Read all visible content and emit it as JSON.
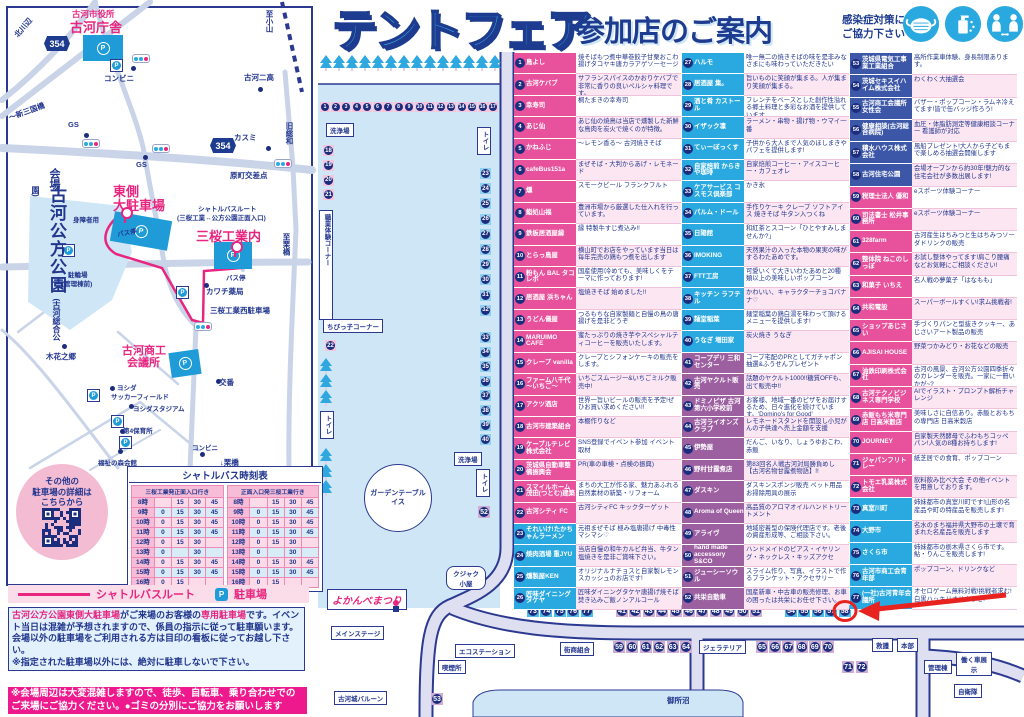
{
  "palette": {
    "pink": "#e8519c",
    "blue": "#2aa9e0",
    "purple": "#9c5fa0",
    "navy": "#3c57a8",
    "accent_pink": "#e8257f",
    "navy_text": "#22368e",
    "park_blue": "#cfe6f6",
    "road_lavender": "#dfdff2",
    "highlight_red": "#e8231f"
  },
  "title": {
    "main": "テントフェア",
    "sub": "参加店のご案内"
  },
  "infection_notice": {
    "text": "感染症対策に\nご協力下さい",
    "icons": [
      "mask-icon",
      "hand-sanitizer-icon",
      "social-distance-icon"
    ]
  },
  "access_map": {
    "park_name_main": "古河公方公園",
    "park_name_sub": "(古河総合公園)",
    "route_shields": [
      "354",
      "354"
    ],
    "qr_caption": "その他の\n駐車場の詳細は\nこちらから",
    "labels": [
      {
        "t": "北川辺",
        "x": 12,
        "y": 22,
        "c": "s",
        "r": -50
      },
      {
        "t": "古河市役所",
        "x": 72,
        "y": 8,
        "c": "pkS"
      },
      {
        "t": "古河庁舎",
        "x": 70,
        "y": 17,
        "c": "pkL"
      },
      {
        "t": "コンビニ",
        "x": 104,
        "y": 73,
        "c": "s"
      },
      {
        "t": "古河二高",
        "x": 244,
        "y": 72,
        "c": "s"
      },
      {
        "t": "至小山",
        "x": 264,
        "y": 10,
        "c": "s",
        "v": 1
      },
      {
        "t": "旧総和",
        "x": 284,
        "y": 122,
        "c": "s",
        "v": 1
      },
      {
        "t": "～新三国橋",
        "x": 8,
        "y": 106,
        "c": "s",
        "r": -20
      },
      {
        "t": "GS",
        "x": 68,
        "y": 120,
        "c": "s"
      },
      {
        "t": "GS",
        "x": 136,
        "y": 160,
        "c": "s"
      },
      {
        "t": "カスミ",
        "x": 234,
        "y": 132,
        "c": "s"
      },
      {
        "t": "原町交差点",
        "x": 230,
        "y": 170,
        "c": "s"
      },
      {
        "t": "会場",
        "x": 46,
        "y": 168,
        "c": "vM",
        "v": 1
      },
      {
        "t": "東側",
        "x": 113,
        "y": 181,
        "c": "pkL"
      },
      {
        "t": "大駐車場",
        "x": 113,
        "y": 195,
        "c": "pkL"
      },
      {
        "t": "身障者用",
        "x": 73,
        "y": 214,
        "c": "xs"
      },
      {
        "t": "バス停",
        "x": 117,
        "y": 227,
        "c": "xs",
        "r": -10
      },
      {
        "t": "シャトルバスルート",
        "x": 198,
        "y": 203,
        "c": "xs"
      },
      {
        "t": "(三桜工業↔公方公園正面入口)",
        "x": 177,
        "y": 212,
        "c": "xs"
      },
      {
        "t": "三桜工業内",
        "x": 196,
        "y": 226,
        "c": "pkL"
      },
      {
        "t": "至栗橋",
        "x": 281,
        "y": 233,
        "c": "s",
        "v": 1
      },
      {
        "t": "バス停",
        "x": 226,
        "y": 272,
        "c": "xs"
      },
      {
        "t": "駐輪場",
        "x": 68,
        "y": 269,
        "c": "xs"
      },
      {
        "t": "(管理棟前)",
        "x": 62,
        "y": 278,
        "c": "xs"
      },
      {
        "t": "カワチ薬局",
        "x": 206,
        "y": 286,
        "c": "s"
      },
      {
        "t": "三桜工業西駐車場",
        "x": 210,
        "y": 305,
        "c": "s"
      },
      {
        "t": "木花之郷",
        "x": 46,
        "y": 351,
        "c": "s"
      },
      {
        "t": "古河商工",
        "x": 122,
        "y": 342,
        "c": "pkM"
      },
      {
        "t": "会議所",
        "x": 127,
        "y": 354,
        "c": "pkM"
      },
      {
        "t": "交番",
        "x": 219,
        "y": 377,
        "c": "s"
      },
      {
        "t": "ヨシダ",
        "x": 117,
        "y": 382,
        "c": "xs"
      },
      {
        "t": "サッカーフィールド",
        "x": 111,
        "y": 391,
        "c": "xs"
      },
      {
        "t": "ヨシダスタジアム",
        "x": 133,
        "y": 403,
        "c": "xs"
      },
      {
        "t": "第4保育所",
        "x": 123,
        "y": 425,
        "c": "xs"
      },
      {
        "t": "コンビニ",
        "x": 192,
        "y": 442,
        "c": "xs"
      },
      {
        "t": "福祉の森会館",
        "x": 98,
        "y": 457,
        "c": "xs"
      },
      {
        "t": "↓栗橋",
        "x": 220,
        "y": 457,
        "c": "s"
      }
    ]
  },
  "timetable": {
    "title": "シャトルバス時刻表",
    "left_header": "三桜工業発正面入口行き",
    "right_header": "正面入口発三桜工業行き",
    "rows": [
      {
        "h": "8時",
        "m": [
          "",
          "15",
          "30",
          "45"
        ]
      },
      {
        "h": "9時",
        "m": [
          "0",
          "15",
          "30",
          "45"
        ]
      },
      {
        "h": "10時",
        "m": [
          "0",
          "15",
          "30",
          "45"
        ]
      },
      {
        "h": "11時",
        "m": [
          "0",
          "15",
          "30",
          "45"
        ]
      },
      {
        "h": "12時",
        "m": [
          "0",
          "15",
          "30",
          ""
        ]
      },
      {
        "h": "13時",
        "m": [
          "0",
          "",
          "30",
          ""
        ]
      },
      {
        "h": "14時",
        "m": [
          "0",
          "15",
          "30",
          "45"
        ]
      },
      {
        "h": "15時",
        "m": [
          "0",
          "15",
          "30",
          "45"
        ]
      },
      {
        "h": "16時",
        "m": [
          "0",
          "15",
          "",
          ""
        ]
      }
    ]
  },
  "legend": {
    "route": "シャトルバスルート",
    "parking": "駐車場",
    "parking_mark": "P"
  },
  "notes": {
    "parking_segments": [
      {
        "t": "古河公方公園東側大駐車場",
        "hl": true
      },
      {
        "t": "がご来場のお客様の",
        "hl": false
      },
      {
        "t": "専用駐車場",
        "hl": true
      },
      {
        "t": "です。イベント当日は混雑が予想されますので、係員の指示に従って駐車願います。会場以外の駐車場をご利用される方は目印の看板に従ってお越し下さい。",
        "hl": false
      },
      {
        "t": "\n※指定された駐車場以外には、絶対に駐車しないで下さい。",
        "hl": false
      }
    ],
    "crowd_note": "※会場周辺は大変混雑しますので、徒歩、自転車、乗り合わせでの\nご来場にご協力ください。●ゴミの分別にご協力をお願いします"
  },
  "venue_map": {
    "highlight_stall": 58,
    "labels": [
      {
        "t": "洗浄場",
        "x": 326,
        "y": 123,
        "c": "box"
      },
      {
        "t": "トイレ",
        "x": 477,
        "y": 127,
        "c": "boxv"
      },
      {
        "t": "職業体験コーナー",
        "x": 319,
        "y": 210,
        "c": "boxv",
        "h": 102
      },
      {
        "t": "ちびっ子コーナー",
        "x": 323,
        "y": 319,
        "c": "box"
      },
      {
        "t": "トイレ",
        "x": 320,
        "y": 411,
        "c": "boxv"
      },
      {
        "t": "洗浄場",
        "x": 454,
        "y": 452,
        "c": "box"
      },
      {
        "t": "トイレ",
        "x": 476,
        "y": 469,
        "c": "boxv"
      },
      {
        "t": "クジャク小屋",
        "x": 446,
        "y": 566,
        "c": "oct"
      },
      {
        "t": "よかんべまつり",
        "x": 327,
        "y": 589,
        "c": "sign"
      },
      {
        "t": "メインステージ",
        "x": 331,
        "y": 626,
        "c": "box"
      },
      {
        "t": "古河城バルーン",
        "x": 334,
        "y": 691,
        "c": "box"
      },
      {
        "t": "エコステーション",
        "x": 455,
        "y": 644,
        "c": "box"
      },
      {
        "t": "喫煙所",
        "x": 438,
        "y": 660,
        "c": "box"
      },
      {
        "t": "街商組合",
        "x": 560,
        "y": 642,
        "c": "box"
      },
      {
        "t": "ジェラテリア",
        "x": 699,
        "y": 640,
        "c": "box"
      },
      {
        "t": "救護",
        "x": 872,
        "y": 638,
        "c": "box"
      },
      {
        "t": "本部",
        "x": 897,
        "y": 638,
        "c": "box"
      },
      {
        "t": "管理棟",
        "x": 924,
        "y": 660,
        "c": "box"
      },
      {
        "t": "働く車展示",
        "x": 956,
        "y": 652,
        "c": "b2"
      },
      {
        "t": "自衛隊",
        "x": 954,
        "y": 684,
        "c": "box"
      },
      {
        "t": "御所沼",
        "x": 664,
        "y": 694,
        "c": "wl"
      }
    ],
    "garden_label": "ガーデンテーブル\nイス",
    "stall_groups": [
      {
        "id": "top-row",
        "color": "pinkL",
        "nums": [
          1,
          2,
          3,
          4,
          5,
          6,
          7,
          8,
          9,
          10,
          11,
          12,
          13,
          14,
          15,
          16,
          17
        ]
      },
      {
        "id": "left-col",
        "color": "pinkL",
        "nums": [
          18,
          19,
          20,
          21
        ]
      },
      {
        "id": "stall-22",
        "color": "pinkL",
        "nums": [
          22
        ]
      },
      {
        "id": "right-col-a",
        "color": "blueL",
        "nums": [
          23,
          24,
          25,
          26,
          27,
          28,
          29,
          30,
          31,
          32
        ]
      },
      {
        "id": "right-col-b",
        "color": "blueL",
        "nums": [
          33,
          34,
          35,
          36,
          37,
          38,
          39,
          40
        ]
      },
      {
        "id": "stall-52",
        "color": "purpleL",
        "nums": [
          52
        ]
      },
      {
        "id": "stall-53",
        "color": "purpleL",
        "nums": [
          53
        ]
      },
      {
        "id": "row-73-77",
        "color": "blueS",
        "nums": [
          73,
          74,
          75,
          76,
          77
        ]
      },
      {
        "id": "row-41-51",
        "color": "purpleL",
        "nums": [
          41,
          42,
          43,
          44,
          45,
          46,
          47,
          48,
          49,
          50,
          51
        ]
      },
      {
        "id": "row-54-58",
        "color": "blueS",
        "nums": [
          54,
          55,
          56,
          57,
          58
        ]
      },
      {
        "id": "row-59-64",
        "color": "purpleL",
        "nums": [
          59,
          60,
          61,
          62,
          63,
          64
        ]
      },
      {
        "id": "row-65-70",
        "color": "purpleL",
        "nums": [
          65,
          66,
          67,
          68,
          69,
          70
        ]
      },
      {
        "id": "row-71-72",
        "color": "purpleL",
        "nums": [
          71,
          72
        ]
      }
    ]
  },
  "stores": [
    {
      "n": 1,
      "name": "鳥よし",
      "desc": "焼そばもつ煮中華巻餃子甘栗おこわ揚げタコヤキ唐カラアゲソーセージ",
      "color": "pink"
    },
    {
      "n": 2,
      "name": "古河ケバブ",
      "desc": "サフランスパイスのかおりケバブで非常に香りの良いペルシャ料理です。",
      "color": "pink"
    },
    {
      "n": 3,
      "name": "幸寿司",
      "desc": "桐たまきの幸寿司",
      "color": "pink"
    },
    {
      "n": 4,
      "name": "あじ仙",
      "desc": "あじ仙の焼鳥は当店で燻製した新鮮な鳥肉を炭火で焼くのが特徴。",
      "color": "pink"
    },
    {
      "n": 5,
      "name": "かねふじ",
      "desc": "～レモン香る～ 古河焼きそば",
      "color": "pink"
    },
    {
      "n": 6,
      "name": "cafeBus151a",
      "desc": "まぜそば・大判からあげ・レモネード",
      "color": "pink"
    },
    {
      "n": 7,
      "name": "燻",
      "desc": "スモークビール フランクフルト",
      "color": "pink"
    },
    {
      "n": 8,
      "name": "鮨処山福",
      "desc": "豊洲市場から厳選した仕入れを行っています。",
      "color": "pink"
    },
    {
      "n": 9,
      "name": "鉄板居酒屋縁",
      "desc": "縁 特製牛すじ煮込み!!",
      "color": "pink"
    },
    {
      "n": 10,
      "name": "とらっ鳥屋",
      "desc": "横山町でお店をやっています当日は毎年完売の鶏もつ煮を出します",
      "color": "pink"
    },
    {
      "n": 11,
      "name": "粉もん BAL タコレボ",
      "desc": "国産使用!冷めても、美味しくをテーマに作っております!",
      "color": "pink"
    },
    {
      "n": 12,
      "name": "居酒屋 浜ちゃん",
      "desc": "塩焼きそば 始めました!!",
      "color": "pink"
    },
    {
      "n": 13,
      "name": "うどん儀屋",
      "desc": "つるもちな自家製麺と自慢の鳥の唐揚げを是非どうぞ",
      "color": "pink"
    },
    {
      "n": 14,
      "name": "MARUIMO CAFE",
      "desc": "蜜たっぷりの焼き芋やスペシャルティコーヒーを販売いたします。",
      "color": "pink"
    },
    {
      "n": 15,
      "name": "クレープ vanilla",
      "desc": "クレープとシフォンケーキの販売をします。",
      "color": "pink"
    },
    {
      "n": 16,
      "name": "ファーム八千代～いちご～",
      "desc": "いちごスムージー&いちごミルク販売中!",
      "color": "pink"
    },
    {
      "n": 17,
      "name": "アクツ酒店",
      "desc": "世界一旨いビールの販売を予定!ぜひお買い求めください!!",
      "color": "pink"
    },
    {
      "n": 18,
      "name": "古河市建築組合",
      "desc": "本棚作りなど",
      "color": "pink"
    },
    {
      "n": 19,
      "name": "ケーブルテレビ株式会社",
      "desc": "SNS登録でイベント参加 イベント取材",
      "color": "pink"
    },
    {
      "n": 20,
      "name": "茨城県自動車整備振興会",
      "desc": "PR(車の車検・点検の振興)",
      "color": "pink"
    },
    {
      "n": 21,
      "name": "スマイルホーム茂田(つとむ)建築",
      "desc": "まちの大工が作る家、魅力あふれる自然素材の新築・リフォーム",
      "color": "pink"
    },
    {
      "n": 22,
      "name": "古河シティ FC",
      "desc": "古河シティFC キックターゲット",
      "color": "pink"
    },
    {
      "n": 23,
      "name": "それいけ!たかちゃんラーメン",
      "desc": "元祖まぜそば 極み塩唐揚げ 中毒性マシマシ♡",
      "color": "blue"
    },
    {
      "n": 24,
      "name": "焼肉酒場 重JYU",
      "desc": "当店自慢の和牛カルビ弁当、牛タン塩焼きを是非ご賞味下さい。",
      "color": "blue"
    },
    {
      "n": 25,
      "name": "燻製屋KEN",
      "desc": "オリジナルナチョスと自家製レモンスカッシュのお店です!",
      "color": "blue"
    },
    {
      "n": 26,
      "name": "匠味ダイニングタケヤ",
      "desc": "匠味ダイニングタケヤ唐揚げ焼そば焚き込みご飯ノンアルコール",
      "color": "blue"
    },
    {
      "n": 27,
      "name": "ハルモ",
      "desc": "唯一無二の焼きそばの味を是非みなさまにも味わっていただきたい",
      "color": "blue"
    },
    {
      "n": 28,
      "name": "居酒屋 集。",
      "desc": "旨いものに笑顔が集まる。人が集まり笑顔が集まる。",
      "color": "blue"
    },
    {
      "n": 29,
      "name": "酒と肴 カストール",
      "desc": "フレンチをベースとした創作性溢れる郷土料理と多彩なお酒を提供しています",
      "color": "blue"
    },
    {
      "n": 30,
      "name": "イザック凛",
      "desc": "ラーメン・串物・揚げ物・ウマイ一番",
      "color": "blue"
    },
    {
      "n": 31,
      "name": "てぃーぼっくす",
      "desc": "子供から大人まで人気のほしまきやパフェを提供します!",
      "color": "blue"
    },
    {
      "n": 32,
      "name": "自家焙煎 からきや珈琲",
      "desc": "自家焙煎コーヒー・アイスコーヒー・カフェオレ",
      "color": "blue"
    },
    {
      "n": 33,
      "name": "ケアサービス コスモス倶楽部",
      "desc": "かき氷",
      "color": "blue"
    },
    {
      "n": 34,
      "name": "パルム・ドール",
      "desc": "手作りケーキ クレープ ソフトアイス 焼きそば 牛タン入つくね",
      "color": "blue"
    },
    {
      "n": 35,
      "name": "日陽館",
      "desc": "和紅茶とスコーン「ひとやすみしませんか?」",
      "color": "blue"
    },
    {
      "n": 36,
      "name": "IMOKING",
      "desc": "天然果汁の入った本物の果実の味がするわたあめです。",
      "color": "blue"
    },
    {
      "n": 37,
      "name": "FTT工房",
      "desc": "可愛いくて大きいわたあめと20種類以上の美味しいポップコーン",
      "color": "blue"
    },
    {
      "n": 38,
      "name": "キッチン ラフテル",
      "desc": "かわいい、キャラクターチョコバナナ♡",
      "color": "blue"
    },
    {
      "n": 39,
      "name": "麺堂稲葉",
      "desc": "麺堂稲葉の鶏白湯を味わって頂けるメニューを提供します!",
      "color": "blue"
    },
    {
      "n": 40,
      "name": "うなぎ 増田家",
      "desc": "炭火焼き うなぎ",
      "color": "blue"
    },
    {
      "n": 41,
      "name": "コープデリ 三和センター",
      "desc": "コープ宅配のPRとしてガチャポン抽選&ふうせんプレゼント",
      "color": "purple"
    },
    {
      "n": 42,
      "name": "古河ヤクルト販売",
      "desc": "話題のヤクルト1000!!糖質OFFも、出て販売中!!",
      "color": "purple"
    },
    {
      "n": 43,
      "name": "ドミノピザ 古河第六小学校前",
      "desc": "お客様、地域一番のピザをお届けするため、日々進化を続けています。'Domino's for Good'",
      "color": "purple"
    },
    {
      "n": 44,
      "name": "古河ライオンズクラブ",
      "desc": "レモネードスタンドを開設し小児がんの子供達へ売上金額を支援",
      "color": "purple"
    },
    {
      "n": 45,
      "name": "伊勢屋",
      "desc": "だんご、いなり、しょうゆおこわ、赤飯",
      "color": "purple"
    },
    {
      "n": 46,
      "name": "野村甘露煮店",
      "desc": "第83回名人戦古河対局勝負めし【古河名物甘露煮物語】!!",
      "color": "purple"
    },
    {
      "n": 47,
      "name": "ダスキン",
      "desc": "ダスキンスポンジ販売 ペット用品お掃除用具の展示",
      "color": "purple"
    },
    {
      "n": 48,
      "name": "Aroma of Queen",
      "desc": "高品質のアロマオイルハンドトリートメント",
      "color": "purple"
    },
    {
      "n": 49,
      "name": "アライヴ",
      "desc": "地域密着型の保険代理店です。老後の資産形成等、ご相談下さい。",
      "color": "purple"
    },
    {
      "n": 50,
      "name": "hand made accessory S&CO",
      "desc": "ハンドメイドのピアス・イヤリング・ネックレス・キッズアクセ",
      "color": "purple"
    },
    {
      "n": 51,
      "name": "ジューシーソウル",
      "desc": "スライム作り、写真、イラストで作るブランケット・アクセサリー",
      "color": "purple"
    },
    {
      "n": 52,
      "name": "共栄自動車",
      "desc": "国産新車・中古車の販売修理、お車の困ったは共栄にお任せ下さい。",
      "color": "purple"
    },
    {
      "n": 53,
      "name": "茨城県電気工事業工業組合",
      "desc": "高所作業車体験、身長制限あります。",
      "color": "navy"
    },
    {
      "n": 54,
      "name": "茨城セキスイハイム株式会社",
      "desc": "わくわく大抽選会",
      "color": "navy"
    },
    {
      "n": 55,
      "name": "古河商工会議所女性会",
      "desc": "バザー・ポップコーン・ラムネ冷えてます!皆で缶バッジ作ろう!",
      "color": "navy"
    },
    {
      "n": 56,
      "name": "健康相談(古河総合病院)",
      "desc": "血圧・体脂肪測定等健康相談コーナー 看護師が対応",
      "color": "navy"
    },
    {
      "n": 57,
      "name": "積水ハウス株式会社",
      "desc": "風船プレゼント!大人から子どもまで楽しめる抽選会開催します",
      "color": "navy"
    },
    {
      "n": 58,
      "name": "古河住宅公園",
      "desc": "会場オープンから約30年!魅力的な住宅会社が多数出展します!",
      "color": "navy"
    },
    {
      "n": 59,
      "name": "税理士法人 優和",
      "desc": "eスポーツ体験コーナー",
      "color": "pink"
    },
    {
      "n": 60,
      "name": "司法書士 松井事務所",
      "desc": "eスポーツ体験コーナー",
      "color": "pink"
    },
    {
      "n": 61,
      "name": "328farm",
      "desc": "古河産生はちみつと生はちみつソーダドリンクの販売",
      "color": "pink"
    },
    {
      "n": 62,
      "name": "整体院 ねこのしっぽ",
      "desc": "お試し整体やってます!肩こり腰痛などお気軽にご相談ください!",
      "color": "pink"
    },
    {
      "n": 63,
      "name": "和菓子 いちえ",
      "desc": "名人戦の夢菓子「はなもも」",
      "color": "pink"
    },
    {
      "n": 64,
      "name": "共和電設",
      "desc": "スーパーボールすくい!求ム挑戦者!",
      "color": "pink"
    },
    {
      "n": 65,
      "name": "ショップあじさい",
      "desc": "手づくりパンと型抜きクッキー、あじさいアート製品の販売",
      "color": "pink"
    },
    {
      "n": 66,
      "name": "AJISAI HOUSE",
      "desc": "野菜つかみどり・お花などの販売",
      "color": "pink"
    },
    {
      "n": 67,
      "name": "油鉄印刷株式会社",
      "desc": "古河の風景、古河公方公園四季折々のカレンダーを販売。一家に一冊いかが~?",
      "color": "pink"
    },
    {
      "n": 68,
      "name": "古河テクノビジネス専門学校",
      "desc": "AIでイラスト・プロンプト解析チャレンジ",
      "color": "pink"
    },
    {
      "n": 69,
      "name": "赤飯もち米専門店 日高米穀店",
      "desc": "美味しさに自信あり。赤飯とおもちの専門店 日高米穀店",
      "color": "pink"
    },
    {
      "n": 70,
      "name": "JOURNEY",
      "desc": "自家製天然酵母でふわもちコッペパン!人気の8種お持ちします!",
      "color": "pink"
    },
    {
      "n": 71,
      "name": "ジャパンフリトレー",
      "desc": "紙芝居での食育、ポップコーン",
      "color": "pink"
    },
    {
      "n": 72,
      "name": "トモエ乳業株式会社",
      "desc": "飲料飲み比べ大会 その他イベントを用意しております。",
      "color": "pink"
    },
    {
      "n": 73,
      "name": "真室川町",
      "desc": "姉妹都市の真室川町です!山形の名産品や町の特産品を販売します!",
      "color": "blue"
    },
    {
      "n": 74,
      "name": "大野市",
      "desc": "名水のまち福井県大野市の土壌で育まれた名産品を販売します",
      "color": "blue"
    },
    {
      "n": 75,
      "name": "さくら市",
      "desc": "姉妹都市の栃木県さくら市です。鮎・りんごを販売します!",
      "color": "blue"
    },
    {
      "n": 76,
      "name": "古河市商工会青年部",
      "desc": "ポップコーン、ドリンクなど",
      "color": "blue"
    },
    {
      "n": 77,
      "name": "(一社)古河青年会議所",
      "desc": "オセロゲーム無料対戦!挑戦者求む!白黒ハッキリさせようぜ!",
      "color": "blue"
    }
  ]
}
